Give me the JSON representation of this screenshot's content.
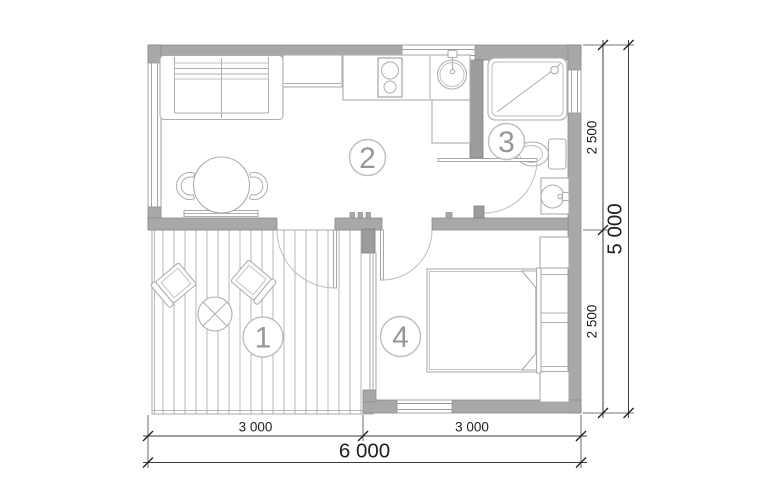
{
  "floor_plan": {
    "type": "architectural-floor-plan",
    "rooms": [
      {
        "number": "1",
        "area": "terrace"
      },
      {
        "number": "2",
        "area": "living-room-kitchen"
      },
      {
        "number": "3",
        "area": "bathroom"
      },
      {
        "number": "4",
        "area": "bedroom"
      }
    ],
    "dimensions": {
      "right": {
        "segments": [
          "2 500",
          "2 500"
        ],
        "total": "5 000"
      },
      "bottom": {
        "segments": [
          "3 000",
          "3 000"
        ],
        "total": "6 000"
      }
    },
    "colors": {
      "wall": "#a8a8a8",
      "furniture_outline": "#aeaeae",
      "room_label": "#979797",
      "dimension_text": "#1f1f1f",
      "deck_plank": "#a6a6a6",
      "background": "#ffffff"
    }
  }
}
